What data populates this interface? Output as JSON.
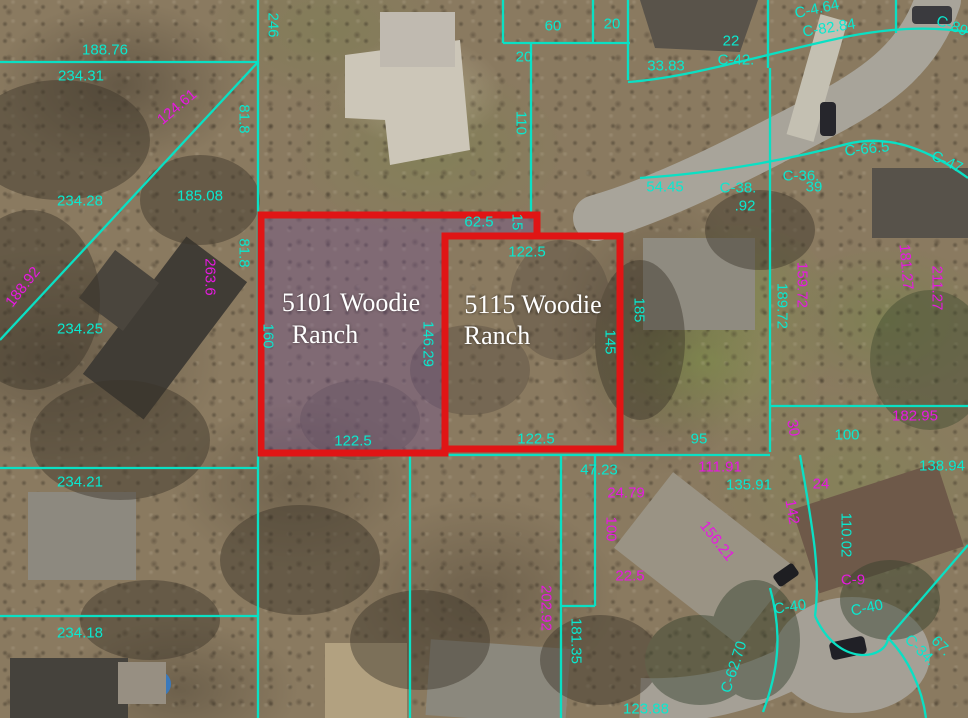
{
  "map": {
    "type": "aerial-parcel-view",
    "highlighted_parcels": [
      {
        "address": "5101 Woodie Ranch"
      },
      {
        "address": "5115 Woodie Ranch"
      }
    ],
    "colors": {
      "parcel_line_cyan": "#0ae0c4",
      "dimension_magenta": "#e619e0",
      "highlight_red": "#e01515",
      "selection_tint_purple": "rgba(108,76,160,0.32)",
      "address_label_white": "#ffffff"
    },
    "labels": {
      "cyan": [
        {
          "t": "188.76",
          "x": 105,
          "y": 50
        },
        {
          "t": "234.31",
          "x": 81,
          "y": 76
        },
        {
          "t": "246",
          "x": 273,
          "y": 25,
          "r": 90
        },
        {
          "t": "81.8",
          "x": 244,
          "y": 119,
          "r": 90
        },
        {
          "t": "234.28",
          "x": 80,
          "y": 201
        },
        {
          "t": "81.8",
          "x": 244,
          "y": 253,
          "r": 90
        },
        {
          "t": "234.25",
          "x": 80,
          "y": 329
        },
        {
          "t": "160",
          "x": 268,
          "y": 336,
          "r": 90
        },
        {
          "t": "234.21",
          "x": 80,
          "y": 482
        },
        {
          "t": "234.18",
          "x": 80,
          "y": 633
        },
        {
          "t": "185.08",
          "x": 200,
          "y": 196
        },
        {
          "t": "60",
          "x": 553,
          "y": 26
        },
        {
          "t": "20",
          "x": 612,
          "y": 24
        },
        {
          "t": "20",
          "x": 524,
          "y": 57
        },
        {
          "t": "110",
          "x": 521,
          "y": 123,
          "r": 90
        },
        {
          "t": "62.5",
          "x": 479,
          "y": 222
        },
        {
          "t": "15",
          "x": 517,
          "y": 222,
          "r": 90
        },
        {
          "t": "122.5",
          "x": 527,
          "y": 252
        },
        {
          "t": "146.29",
          "x": 428,
          "y": 344,
          "r": 90
        },
        {
          "t": "145",
          "x": 610,
          "y": 342,
          "r": 90
        },
        {
          "t": "185",
          "x": 639,
          "y": 310,
          "r": 90
        },
        {
          "t": "122.5",
          "x": 353,
          "y": 441
        },
        {
          "t": "122.5",
          "x": 536,
          "y": 439
        },
        {
          "t": "47.23",
          "x": 599,
          "y": 470
        },
        {
          "t": "95",
          "x": 699,
          "y": 439
        },
        {
          "t": "100",
          "x": 847,
          "y": 435
        },
        {
          "t": "138.94",
          "x": 942,
          "y": 466
        },
        {
          "t": "135.91",
          "x": 749,
          "y": 485
        },
        {
          "t": "110.02",
          "x": 846,
          "y": 535,
          "r": 90
        },
        {
          "t": "181.35",
          "x": 576,
          "y": 641,
          "r": 90
        },
        {
          "t": "123.88",
          "x": 646,
          "y": 709
        },
        {
          "t": "C-40",
          "x": 790,
          "y": 607,
          "r": -8
        },
        {
          "t": "C-40",
          "x": 867,
          "y": 608,
          "r": -12
        },
        {
          "t": "C-62.70",
          "x": 734,
          "y": 667,
          "r": -72
        },
        {
          "t": "C-34.",
          "x": 920,
          "y": 650,
          "r": 45
        },
        {
          "t": "67.",
          "x": 941,
          "y": 646,
          "r": 45
        },
        {
          "t": "33.83",
          "x": 666,
          "y": 66
        },
        {
          "t": "22",
          "x": 731,
          "y": 41
        },
        {
          "t": "C-42.",
          "x": 736,
          "y": 60
        },
        {
          "t": "C-4.64",
          "x": 817,
          "y": 9,
          "r": -12
        },
        {
          "t": "C-82.84",
          "x": 829,
          "y": 28,
          "r": -9
        },
        {
          "t": "C-89",
          "x": 952,
          "y": 26,
          "r": 22
        },
        {
          "t": "54.45",
          "x": 665,
          "y": 187
        },
        {
          "t": "C-38.",
          "x": 738,
          "y": 188
        },
        {
          "t": ".92",
          "x": 745,
          "y": 206
        },
        {
          "t": "C-36.",
          "x": 801,
          "y": 176
        },
        {
          "t": "39",
          "x": 814,
          "y": 187
        },
        {
          "t": "C-66.5",
          "x": 867,
          "y": 149,
          "r": -6
        },
        {
          "t": "C-47",
          "x": 947,
          "y": 162,
          "r": 25
        },
        {
          "t": "189.72",
          "x": 782,
          "y": 306,
          "r": 90
        }
      ],
      "magenta": [
        {
          "t": "124.61",
          "x": 177,
          "y": 107,
          "r": -40
        },
        {
          "t": "188.92",
          "x": 23,
          "y": 287,
          "r": -52
        },
        {
          "t": "263.6",
          "x": 210,
          "y": 277,
          "r": 90
        },
        {
          "t": "159.72",
          "x": 802,
          "y": 285,
          "r": 90
        },
        {
          "t": "181.27",
          "x": 906,
          "y": 267,
          "r": 85
        },
        {
          "t": "211.27",
          "x": 937,
          "y": 288,
          "r": 90
        },
        {
          "t": "111.91",
          "x": 720,
          "y": 467
        },
        {
          "t": "182.95",
          "x": 915,
          "y": 416
        },
        {
          "t": "24.79",
          "x": 626,
          "y": 493
        },
        {
          "t": "100",
          "x": 611,
          "y": 529,
          "r": 90
        },
        {
          "t": "22.5",
          "x": 630,
          "y": 576
        },
        {
          "t": "202.92",
          "x": 546,
          "y": 608,
          "r": 90
        },
        {
          "t": "156.21",
          "x": 717,
          "y": 541,
          "r": 52
        },
        {
          "t": "142",
          "x": 792,
          "y": 512,
          "r": 80
        },
        {
          "t": "24",
          "x": 821,
          "y": 484
        },
        {
          "t": "C-9",
          "x": 853,
          "y": 580
        },
        {
          "t": "30",
          "x": 793,
          "y": 428,
          "r": 80
        }
      ],
      "white": [
        {
          "t": "5101 Woodie",
          "x": 351,
          "y": 303
        },
        {
          "t": "Ranch",
          "x": 325,
          "y": 335
        },
        {
          "t": "5115 Woodie",
          "x": 533,
          "y": 305
        },
        {
          "t": "Ranch",
          "x": 497,
          "y": 336
        }
      ]
    },
    "geometry": {
      "red_outlines": [
        {
          "name": "parcel-5101-outline",
          "d": "M261,215 H537 V236 H445 V453 H261 Z"
        },
        {
          "name": "parcel-5115-outline",
          "d": "M445,236 H620 V449 H445 Z"
        }
      ],
      "selection_tint": "M261,215 H537 V236 H445 V453 H261 Z",
      "cyan_lines": [
        "M0,62 H258",
        "M258,0 V718",
        "M0,340 L258,62",
        "M0,468 H258",
        "M0,616 H258",
        "M503,0 V43",
        "M503,43 H630",
        "M593,0 V43",
        "M628,0 V80",
        "M531,43 V212",
        "M768,0 V68",
        "M896,0 V33",
        "M628,82 C690,78 780,50 850,36 C892,28 930,26 968,32",
        "M640,178 C720,173 795,158 847,144 C892,133 932,152 968,178",
        "M770,68 V452",
        "M770,406 H968",
        "M258,455 H770",
        "M410,455 V718",
        "M561,455 V718",
        "M595,455 V606",
        "M561,606 H595",
        "M800,455 C812,525 821,570 815,616",
        "M815,616 C838,668 886,660 888,638",
        "M888,638 C908,658 922,688 926,718",
        "M968,545 L888,638",
        "M770,588 C783,635 778,672 763,712"
      ]
    }
  }
}
